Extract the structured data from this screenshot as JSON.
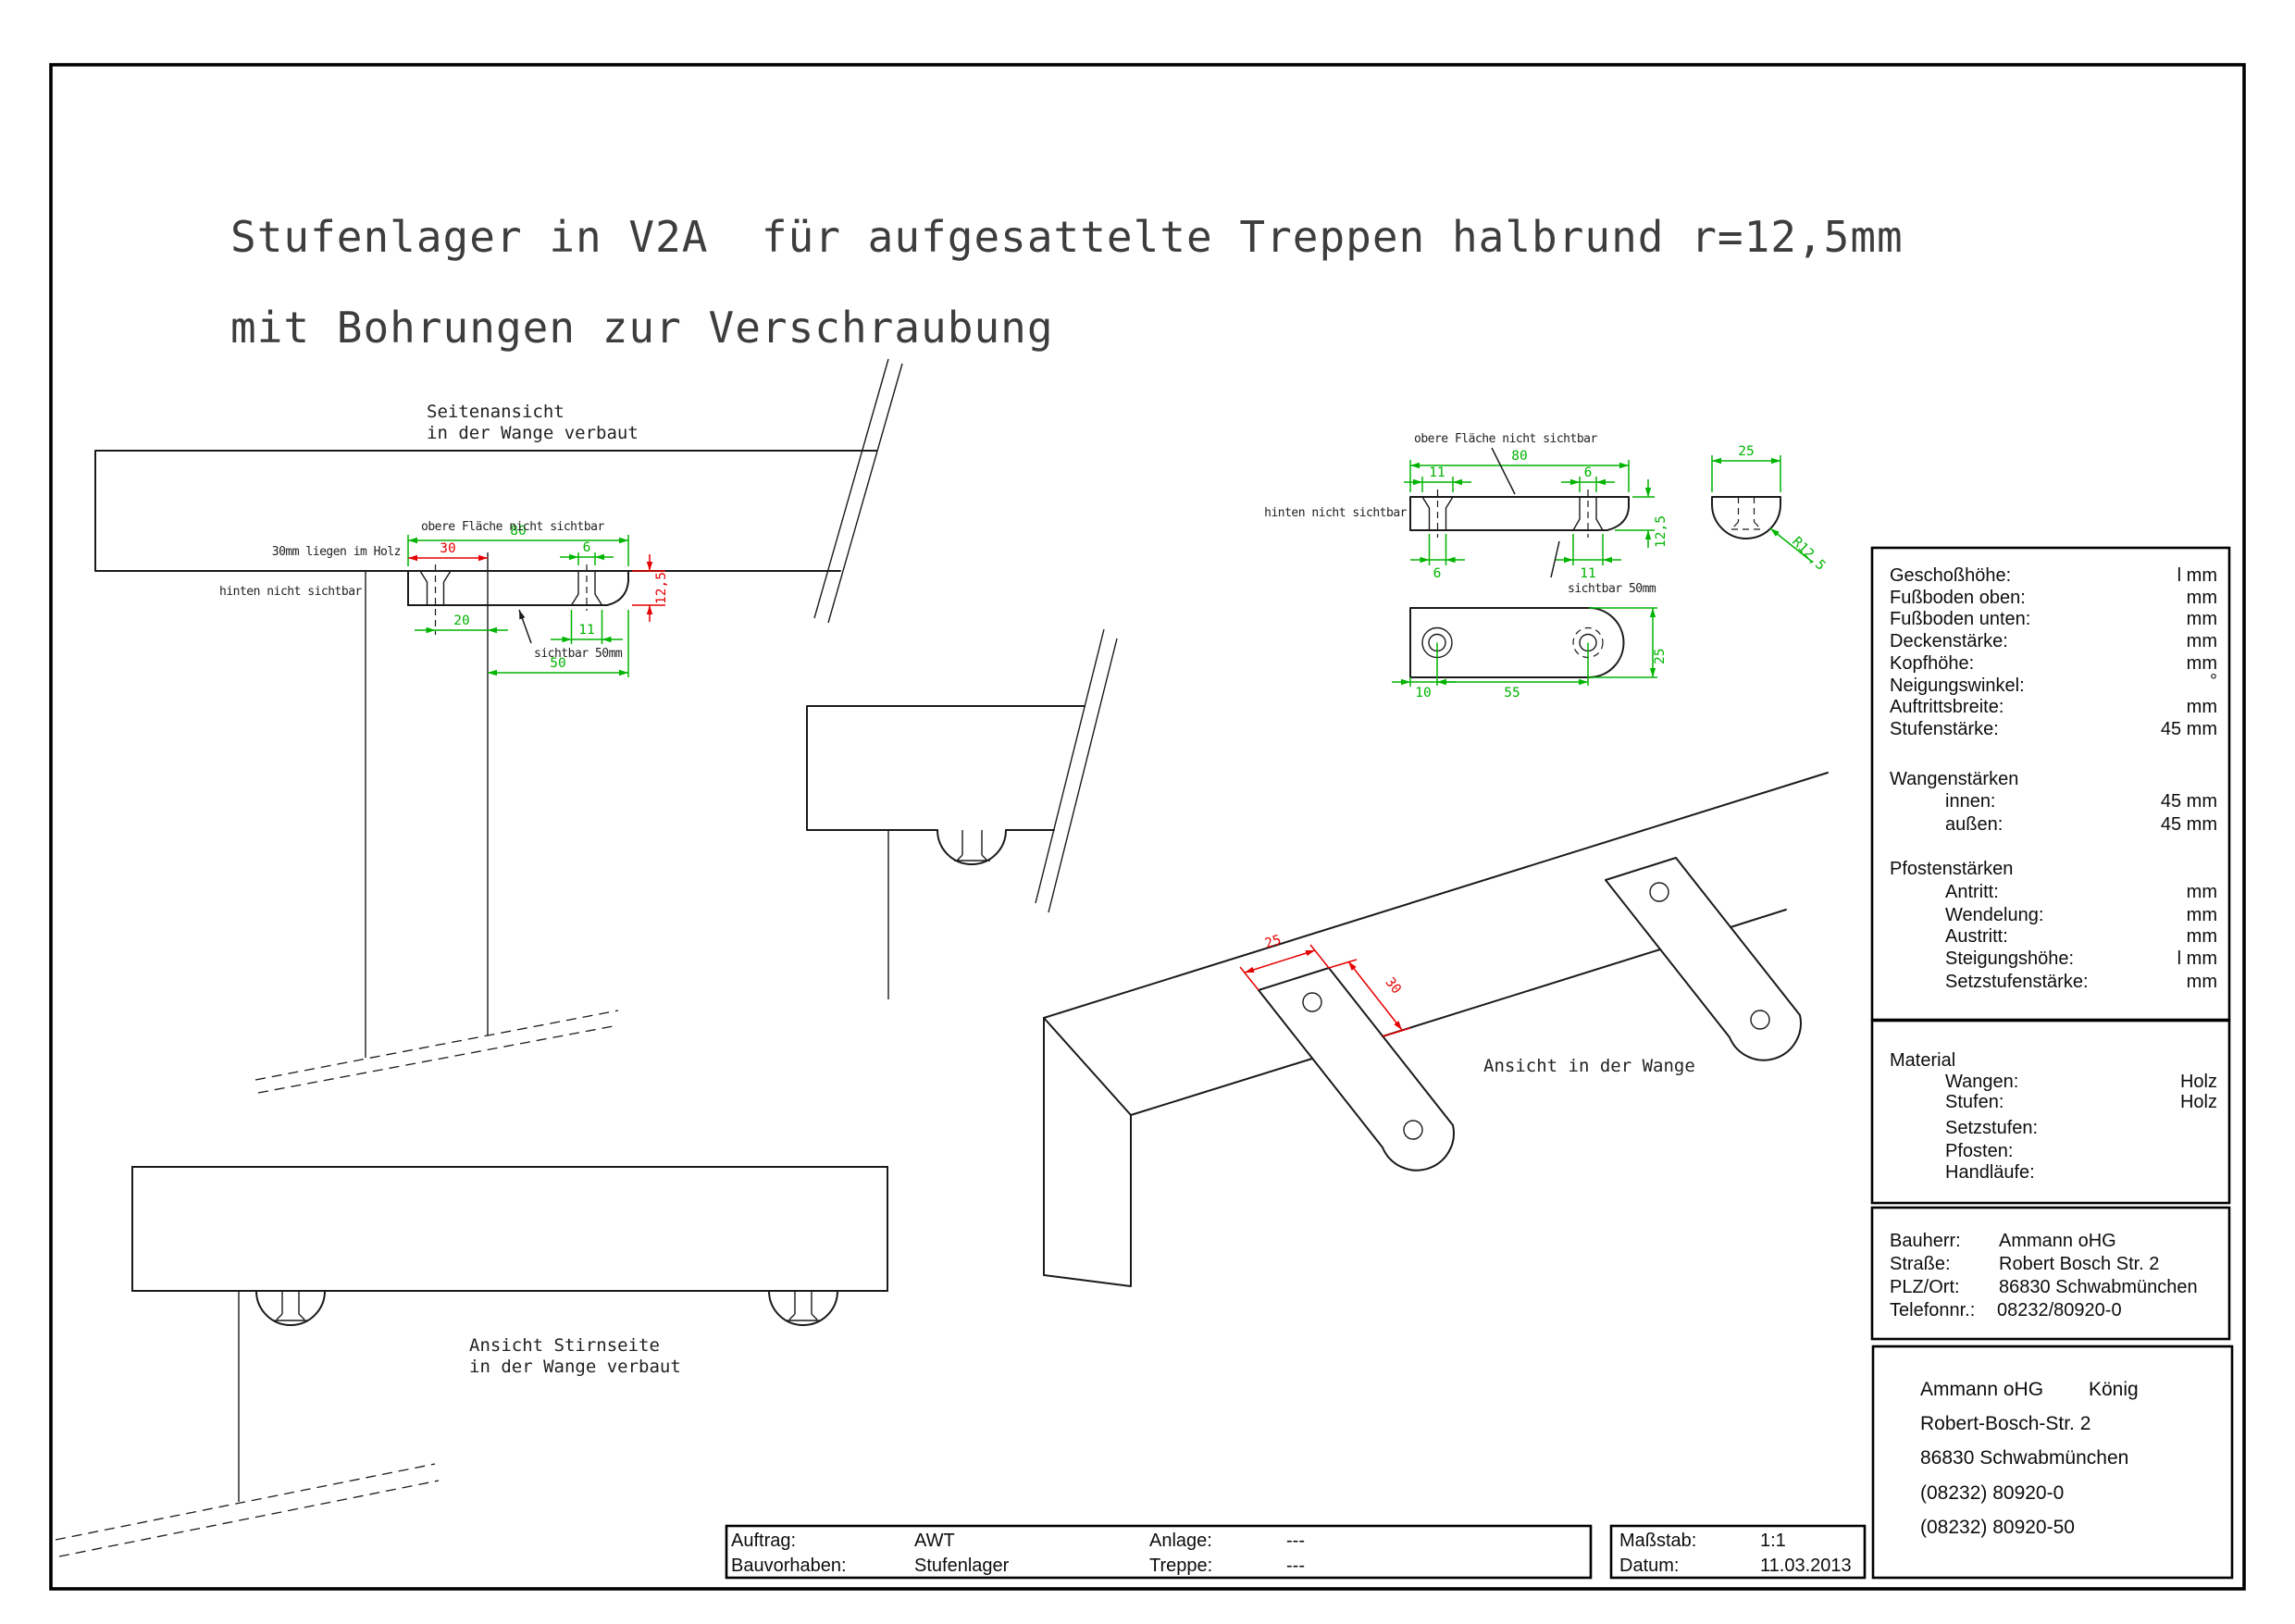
{
  "title": {
    "line1": "Stufenlager in V2A  für aufgesattelte Treppen halbrund r=12,5mm",
    "line2": "mit Bohrungen zur Verschraubung"
  },
  "colors": {
    "dimension_green": "#00b400",
    "dimension_red": "#e60000",
    "line_black": "#1a1a1a"
  },
  "views": {
    "side_view": {
      "title_1": "Seitenansicht",
      "title_2": "in der Wange verbaut",
      "note_top": "obere Fläche nicht sichtbar",
      "note_wood": "30mm liegen im Holz",
      "note_back": "hinten nicht sichtbar",
      "note_visible": "sichtbar 50mm",
      "dim_80": "80",
      "dim_30": "30",
      "dim_6": "6",
      "dim_12_5": "12,5",
      "dim_20": "20",
      "dim_11": "11",
      "dim_50": "50"
    },
    "detail_views": {
      "note_top": "obere Fläche nicht sichtbar",
      "note_back": "hinten nicht sichtbar",
      "note_visible": "sichtbar 50mm",
      "dim_80": "80",
      "dim_11_top": "11",
      "dim_6_top": "6",
      "dim_12_5": "12,5",
      "dim_6_bottom": "6",
      "dim_11_bottom": "11",
      "dim_25_end": "25",
      "radius": "R12,5",
      "dim_10": "10",
      "dim_55": "55",
      "dim_25_plan": "25"
    },
    "front_view": {
      "title_1": "Ansicht Stirnseite",
      "title_2": "in der Wange verbaut"
    },
    "iso_view": {
      "title": "Ansicht in der Wange",
      "dim_25": "25",
      "dim_30": "30"
    }
  },
  "panel": {
    "specs": {
      "rows": [
        {
          "label": "Geschoßhöhe:",
          "value": "l mm"
        },
        {
          "label": "Fußboden oben:",
          "value": "mm"
        },
        {
          "label": "Fußboden unten:",
          "value": "mm"
        },
        {
          "label": "Deckenstärke:",
          "value": "mm"
        },
        {
          "label": "Kopfhöhe:",
          "value": "mm"
        },
        {
          "label": "Neigungswinkel:",
          "value": "°"
        },
        {
          "label": "Auftrittsbreite:",
          "value": "mm"
        },
        {
          "label": "Stufenstärke:",
          "value": "45 mm"
        }
      ],
      "wangen": {
        "header": "Wangenstärken",
        "rows": [
          {
            "label": "innen:",
            "value": "45 mm"
          },
          {
            "label": "außen:",
            "value": "45 mm"
          }
        ]
      },
      "pfosten": {
        "header": "Pfostenstärken",
        "rows": [
          {
            "label": "Antritt:",
            "value": "mm"
          },
          {
            "label": "Wendelung:",
            "value": "mm"
          },
          {
            "label": "Austritt:",
            "value": "mm"
          },
          {
            "label": "Steigungshöhe:",
            "value": "l mm"
          },
          {
            "label": "Setzstufenstärke:",
            "value": "mm"
          }
        ]
      }
    },
    "material": {
      "header": "Material",
      "rows": [
        {
          "label": "Wangen:",
          "value": "Holz"
        },
        {
          "label": "Stufen:",
          "value": "Holz"
        },
        {
          "label": "Setzstufen:",
          "value": ""
        },
        {
          "label": "Pfosten:",
          "value": ""
        },
        {
          "label": "Handläufe:",
          "value": ""
        }
      ]
    },
    "bauherr": {
      "rows": [
        {
          "label": "Bauherr:",
          "value": "Ammann oHG"
        },
        {
          "label": "Straße:",
          "value": "Robert Bosch Str. 2"
        },
        {
          "label": "PLZ/Ort:",
          "value": "86830 Schwabmünchen"
        },
        {
          "label": "Telefonnr.:",
          "value": "08232/80920-0"
        }
      ]
    },
    "company": {
      "name": "Ammann oHG",
      "contact": "König",
      "street": "Robert-Bosch-Str. 2",
      "city": "86830 Schwabmünchen",
      "phone_1": "(08232) 80920-0",
      "phone_2": "(08232) 80920-50"
    }
  },
  "footer": {
    "auftrag_label": "Auftrag:",
    "auftrag_value": "AWT",
    "bauvorhaben_label": "Bauvorhaben:",
    "bauvorhaben_value": "Stufenlager",
    "anlage_label": "Anlage:",
    "anlage_value": "---",
    "treppe_label": "Treppe:",
    "treppe_value": "---",
    "massstab_label": "Maßstab:",
    "massstab_value": "1:1",
    "datum_label": "Datum:",
    "datum_value": "11.03.2013"
  }
}
